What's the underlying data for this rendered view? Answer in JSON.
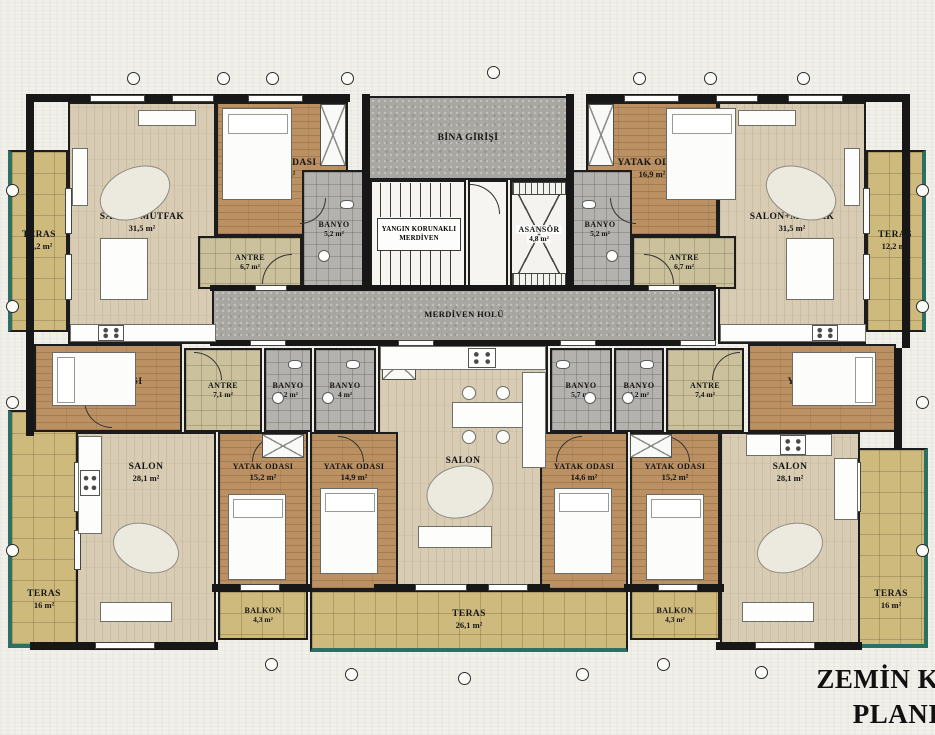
{
  "title": {
    "line1": "ZEMİN KAT",
    "line2": "PLANI"
  },
  "entrance": {
    "label": "BİNA GİRİŞİ"
  },
  "stairs": {
    "line1": "YANGIN KORUNAKLI",
    "line2": "MERDİVEN"
  },
  "hall": {
    "label": "MERDİVEN HOLÜ"
  },
  "elevator": {
    "label": "ASANSÖR",
    "area": "4,8 m²"
  },
  "colors": {
    "wall": "#171717",
    "paper": "#f1f0ea",
    "terrace_tile": "#cfba7e",
    "wood_light": "#d9ccb4",
    "wood_dark": "#bb9164",
    "hall_gray": "#a9a7a2",
    "bath_gray": "#b3b2ae",
    "antre_tan": "#ccc19d",
    "pool_edge_teal": "#2f6f63"
  },
  "rooms": [
    {
      "id": "teras-top-left",
      "label": "TERAS",
      "area": "12,2 m²"
    },
    {
      "id": "salon-mutfak-left",
      "label": "SALON+MUTFAK",
      "area": "31,5 m²"
    },
    {
      "id": "yatak-top-left",
      "label": "YATAK ODASI",
      "area": "16,9 m²"
    },
    {
      "id": "antre-top-left",
      "label": "ANTRE",
      "area": "6,7 m²"
    },
    {
      "id": "banyo-top-left",
      "label": "BANYO",
      "area": "5,2 m²"
    },
    {
      "id": "yatak-top-right",
      "label": "YATAK ODASI",
      "area": "16,9 m²"
    },
    {
      "id": "salon-mutfak-right",
      "label": "SALON+MUTFAK",
      "area": "31,5 m²"
    },
    {
      "id": "teras-top-right",
      "label": "TERAS",
      "area": "12,2 m²"
    },
    {
      "id": "banyo-top-right",
      "label": "BANYO",
      "area": "5,2 m²"
    },
    {
      "id": "antre-top-right",
      "label": "ANTRE",
      "area": "6,7 m²"
    },
    {
      "id": "yatak-mid-left",
      "label": "YATAK ODASI",
      "area": "13,6 m²"
    },
    {
      "id": "antre-bottom-left",
      "label": "ANTRE",
      "area": "7,1 m²"
    },
    {
      "id": "banyo-bottom-left",
      "label": "BANYO",
      "area": "4,2 m²"
    },
    {
      "id": "banyo-center-left",
      "label": "BANYO",
      "area": "4 m²"
    },
    {
      "id": "salon-center",
      "label": "SALON",
      "area": "36,9 m²"
    },
    {
      "id": "banyo-center-right",
      "label": "BANYO",
      "area": "5,7 m²"
    },
    {
      "id": "banyo-bottom-right",
      "label": "BANYO",
      "area": "4,2 m²"
    },
    {
      "id": "antre-bottom-right",
      "label": "ANTRE",
      "area": "7,4 m²"
    },
    {
      "id": "yatak-mid-right",
      "label": "YATAK ODASI",
      "area": "13,6 m²"
    },
    {
      "id": "salon-bottom-left",
      "label": "SALON",
      "area": "28,1 m²"
    },
    {
      "id": "yatak-bl-2",
      "label": "YATAK ODASI",
      "area": "15,2 m²"
    },
    {
      "id": "yatak-center-1",
      "label": "YATAK ODASI",
      "area": "14,9 m²"
    },
    {
      "id": "yatak-center-2",
      "label": "YATAK ODASI",
      "area": "14,6 m²"
    },
    {
      "id": "yatak-br-2",
      "label": "YATAK ODASI",
      "area": "15,2 m²"
    },
    {
      "id": "salon-bottom-right",
      "label": "SALON",
      "area": "28,1 m²"
    },
    {
      "id": "teras-bottom-left",
      "label": "TERAS",
      "area": "16 m²"
    },
    {
      "id": "balkon-left",
      "label": "BALKON",
      "area": "4,3 m²"
    },
    {
      "id": "teras-bottom-center",
      "label": "TERAS",
      "area": "26,1 m²"
    },
    {
      "id": "balkon-right",
      "label": "BALKON",
      "area": "4,3 m²"
    },
    {
      "id": "teras-bottom-right",
      "label": "TERAS",
      "area": "16 m²"
    }
  ]
}
